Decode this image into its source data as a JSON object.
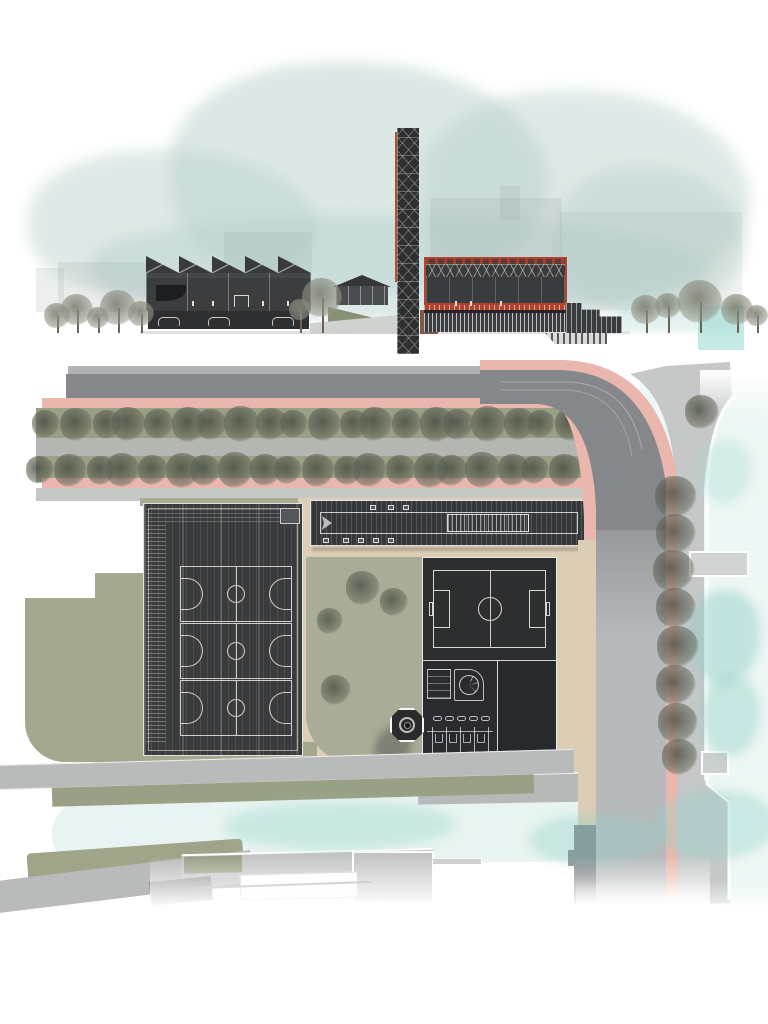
{
  "scene": {
    "type": "architectural-presentation-drawing",
    "views": [
      "section-elevation",
      "roof-site-plan"
    ],
    "text_content": "none"
  },
  "palette": {
    "paper": "#ffffff",
    "sky_wash": "#bcd4d0",
    "ink_dark": "#343538",
    "roof_dark": "#313234",
    "accent_red": "#b2432e",
    "band_maroon": "#5a3a33",
    "bike_pink": "#eab7ae",
    "road_dark": "#85878a",
    "road_light": "#b7b9bb",
    "promenade": "#c6c8c8",
    "sidewalk": "#c3c5c2",
    "sand": "#dccdb5",
    "grass": "#a6aa90",
    "grass_dark": "#99a083",
    "water": "#e9f6f3",
    "water_tint": "#bfe7e1",
    "white_line": "#f2f2f2",
    "tree_plan": "#5f6456",
    "tree_elev": "#8d9183"
  },
  "elevation": {
    "sawtooth_count": 5,
    "car_x": [
      158,
      208,
      272
    ],
    "figures_x": [
      192,
      212,
      262,
      287,
      455,
      470,
      500
    ],
    "sky_blobs": [
      {
        "x": 28,
        "y": 150,
        "w": 290,
        "h": 150,
        "o": 0.45
      },
      {
        "x": 170,
        "y": 62,
        "w": 380,
        "h": 230,
        "o": 0.5
      },
      {
        "x": 420,
        "y": 90,
        "w": 330,
        "h": 210,
        "o": 0.45
      },
      {
        "x": 555,
        "y": 165,
        "w": 190,
        "h": 150,
        "o": 0.45
      },
      {
        "x": 90,
        "y": 215,
        "w": 620,
        "h": 105,
        "o": 0.5
      }
    ],
    "silhouettes": [
      {
        "x": 36,
        "y": 268,
        "w": 28,
        "h": 44,
        "o": 0.5
      },
      {
        "x": 58,
        "y": 262,
        "w": 88,
        "h": 50,
        "o": 0.55
      },
      {
        "x": 224,
        "y": 232,
        "w": 88,
        "h": 44,
        "o": 0.5
      },
      {
        "x": 430,
        "y": 198,
        "w": 132,
        "h": 72,
        "o": 0.55
      },
      {
        "x": 500,
        "y": 186,
        "w": 20,
        "h": 34,
        "o": 0.6
      },
      {
        "x": 560,
        "y": 212,
        "w": 182,
        "h": 98,
        "o": 0.35
      }
    ],
    "trees": [
      {
        "x": 57,
        "y": 316,
        "s": 26
      },
      {
        "x": 77,
        "y": 310,
        "s": 32
      },
      {
        "x": 98,
        "y": 318,
        "s": 22
      },
      {
        "x": 118,
        "y": 308,
        "s": 36
      },
      {
        "x": 141,
        "y": 314,
        "s": 26
      },
      {
        "x": 322,
        "y": 298,
        "s": 40
      },
      {
        "x": 300,
        "y": 310,
        "s": 22
      },
      {
        "x": 646,
        "y": 310,
        "s": 30
      },
      {
        "x": 668,
        "y": 306,
        "s": 26
      },
      {
        "x": 700,
        "y": 302,
        "s": 44
      },
      {
        "x": 737,
        "y": 310,
        "s": 32
      },
      {
        "x": 757,
        "y": 316,
        "s": 22
      }
    ]
  },
  "plan": {
    "avenue": {
      "row1": {
        "y": 424,
        "start": 46,
        "step": 27.5,
        "count": 20,
        "base_size": 28
      },
      "row2": {
        "y": 470,
        "start": 40,
        "step": 27.5,
        "count": 20,
        "base_size": 28
      }
    },
    "promenade_trees": [
      {
        "x": 702,
        "y": 412,
        "s": 34
      },
      {
        "x": 676,
        "y": 497,
        "s": 42
      },
      {
        "x": 676,
        "y": 534,
        "s": 40
      },
      {
        "x": 674,
        "y": 571,
        "s": 42
      },
      {
        "x": 676,
        "y": 608,
        "s": 40
      },
      {
        "x": 678,
        "y": 647,
        "s": 42
      },
      {
        "x": 676,
        "y": 685,
        "s": 40
      },
      {
        "x": 678,
        "y": 723,
        "s": 40
      },
      {
        "x": 680,
        "y": 757,
        "s": 36
      }
    ],
    "courtyard_trees": [
      {
        "x": 363,
        "y": 588,
        "s": 34
      },
      {
        "x": 394,
        "y": 602,
        "s": 28
      },
      {
        "x": 330,
        "y": 621,
        "s": 26
      },
      {
        "x": 336,
        "y": 690,
        "s": 30
      }
    ],
    "courts": {
      "count": 3,
      "x": 180,
      "y": 566,
      "w": 112,
      "h": 56
    },
    "pills": {
      "count": 5,
      "x": 433,
      "y": 716,
      "step": 12
    },
    "stalls": {
      "count": 5,
      "x": 432,
      "step": 14,
      "top": 727,
      "bottom": 763
    },
    "roof_squares_top": [
      370,
      388,
      403
    ],
    "roof_squares_bottom": [
      323,
      343,
      358,
      373,
      388
    ]
  }
}
